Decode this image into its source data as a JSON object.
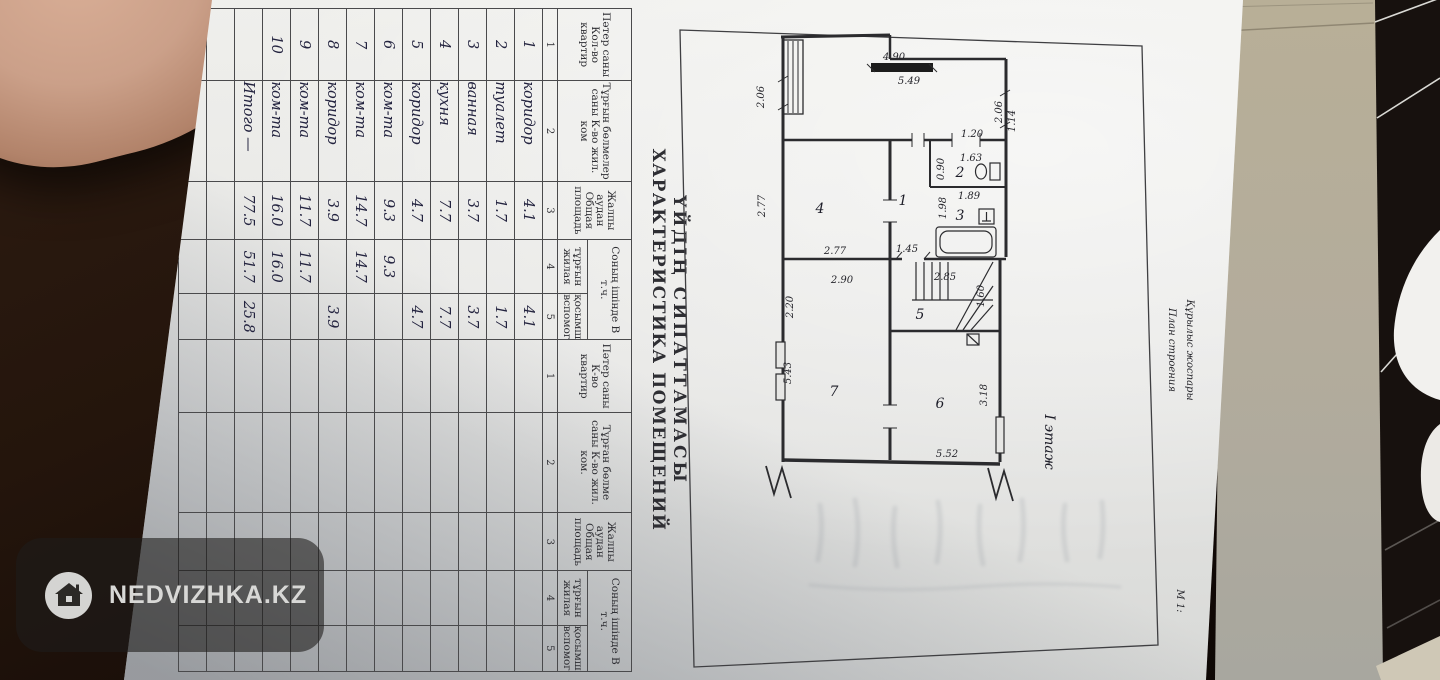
{
  "document": {
    "title_line1": "ҮЙДІҢ СИПАТТАМАСЫ",
    "title_line2": "ХАРАКТЕРИСТИКА ПОМЕЩЕНИЙ"
  },
  "table": {
    "header": {
      "col1": "Пәтер саны Кол-во квартир",
      "col2": "Тұрғын бөлмелер саны К-во жил. ком",
      "col3": "Жалпы аудан Общая площадь",
      "group45": "Соның ішінде В т.ч.",
      "col4": "тұрғын жилая",
      "col5": "қосымша вспомог.",
      "col1b": "Пәтер саны К-во квартир",
      "col2b": "Тұрған бөлме саны К-во жил. ком."
    },
    "index": [
      "1",
      "2",
      "3",
      "4",
      "5"
    ],
    "rows": [
      {
        "n": "1",
        "name": "коридор",
        "total": "4.1",
        "living": "",
        "aux": "4.1"
      },
      {
        "n": "2",
        "name": "туалет",
        "total": "1.7",
        "living": "",
        "aux": "1.7"
      },
      {
        "n": "3",
        "name": "ванная",
        "total": "3.7",
        "living": "",
        "aux": "3.7"
      },
      {
        "n": "4",
        "name": "кухня",
        "total": "7.7",
        "living": "",
        "aux": "7.7"
      },
      {
        "n": "5",
        "name": "коридор",
        "total": "4.7",
        "living": "",
        "aux": "4.7"
      },
      {
        "n": "6",
        "name": "ком-та",
        "total": "9.3",
        "living": "9.3",
        "aux": ""
      },
      {
        "n": "7",
        "name": "ком-та",
        "total": "14.7",
        "living": "14.7",
        "aux": ""
      },
      {
        "n": "8",
        "name": "коридор",
        "total": "3.9",
        "living": "",
        "aux": "3.9"
      },
      {
        "n": "9",
        "name": "ком-та",
        "total": "11.7",
        "living": "11.7",
        "aux": ""
      },
      {
        "n": "10",
        "name": "ком-та",
        "total": "16.0",
        "living": "16.0",
        "aux": ""
      }
    ],
    "totals": {
      "label": "Итого —",
      "total": "77.5",
      "living": "51.7",
      "aux": "25.8"
    }
  },
  "plan": {
    "heading1": "Құрылыс жоспары",
    "heading2": "План строения",
    "scale": "М 1:",
    "floor": "I этаж",
    "rooms": {
      "r1": "1",
      "r2": "2",
      "r3": "3",
      "r4": "4",
      "r5": "5",
      "r6": "6",
      "r7": "7"
    },
    "dims": {
      "d490": "4.90",
      "d549": "5.49",
      "d206l": "2.06",
      "d206r": "2.06",
      "d120": "1.20",
      "d163": "1.63",
      "d090": "0.90",
      "d189": "1.89",
      "d198": "1.98",
      "d114": "1.14",
      "d285": "2.85",
      "d160": "1.60",
      "d145": "1.45",
      "d277v": "2.77",
      "d277h": "2.77",
      "d290": "2.90",
      "d220": "2.20",
      "d543": "5.43",
      "d318": "3.18",
      "d552": "5.52"
    }
  },
  "watermark": {
    "text": "NEDVIZHKA.KZ",
    "icon": "house-icon"
  },
  "colors": {
    "paper": "#e8e8e6",
    "ink": "#2e2e33",
    "handwriting": "#23233f",
    "backdrop_black": "#17120f",
    "cardboard": "#b6ad99",
    "skin": "#c79d85",
    "watermark_bg": "rgba(30,28,26,0.6)",
    "watermark_text": "#d8d8d6"
  }
}
